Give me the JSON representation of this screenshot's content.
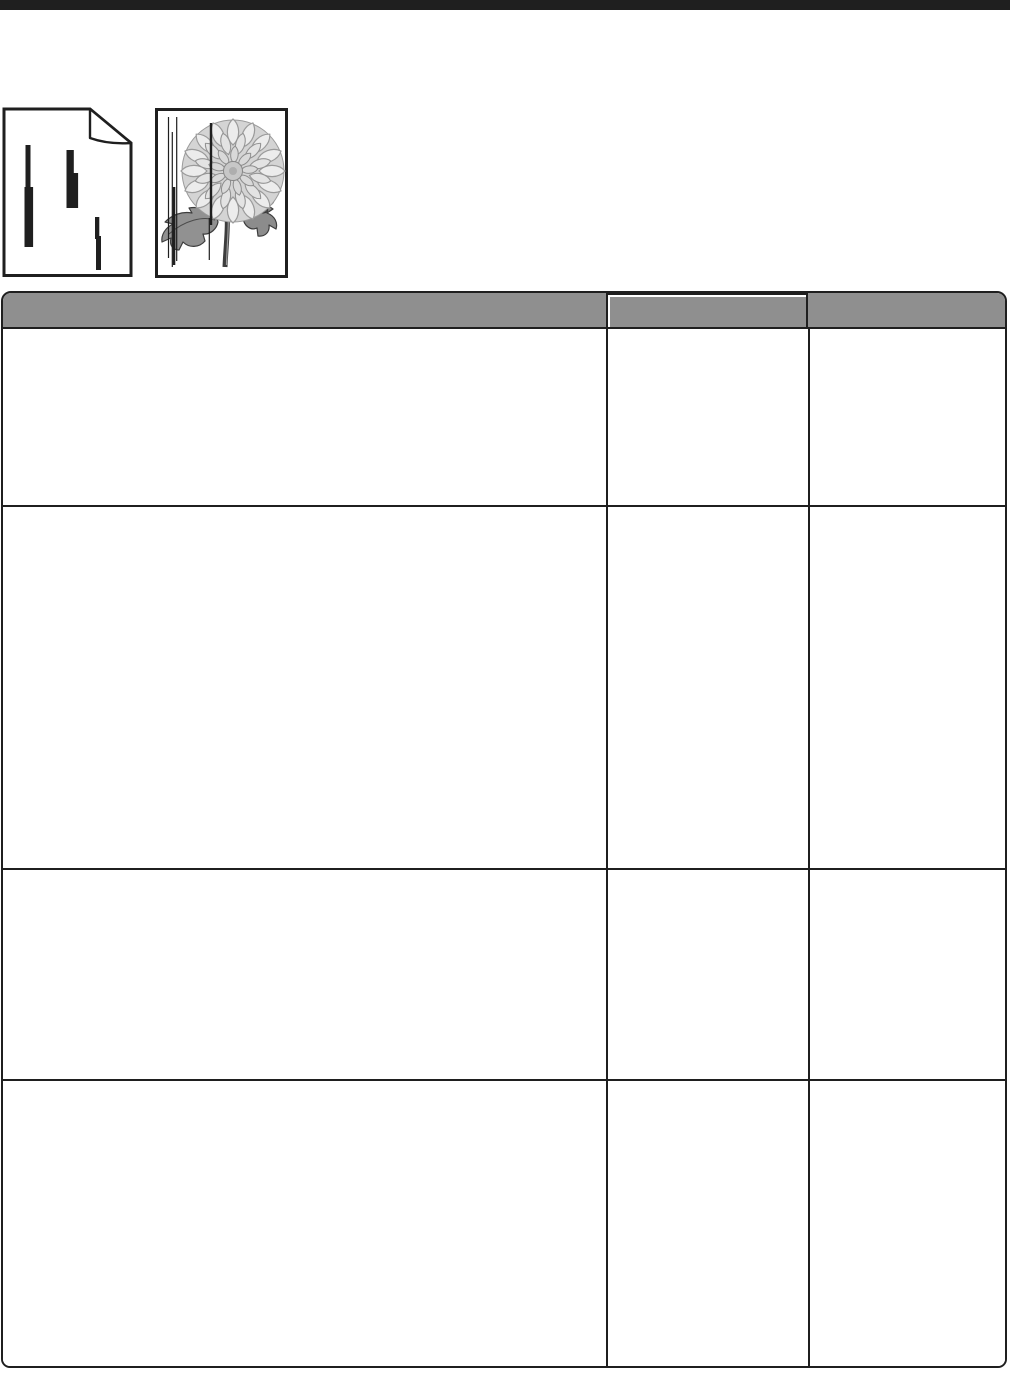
{
  "theme": {
    "ink": "#1f1f1f",
    "header-bg": "#8f8f8f",
    "paper": "#ffffff"
  },
  "page": {
    "top_rule": {
      "color": "#1f1f1f"
    }
  },
  "illustrations": [
    {
      "name": "streaked-page",
      "description": "Printed page icon with folded corner showing three vertical black streaks",
      "streak_color": "#1f1f1f"
    },
    {
      "name": "streaked-flower",
      "description": "Grayscale flower print sample crossed by thin vertical black defect lines",
      "line_color": "#1f1f1f"
    }
  ],
  "table": {
    "style": {
      "header_background": "#8f8f8f",
      "border_color": "#1f1f1f",
      "body_background": "#ffffff"
    },
    "columns": [
      {
        "label": ""
      },
      {
        "label": ""
      },
      {
        "label": ""
      }
    ],
    "rows": [
      {
        "cells": [
          "",
          "",
          ""
        ]
      },
      {
        "cells": [
          "",
          "",
          ""
        ]
      },
      {
        "cells": [
          "",
          "",
          ""
        ]
      },
      {
        "cells": [
          "",
          "",
          ""
        ]
      }
    ]
  }
}
